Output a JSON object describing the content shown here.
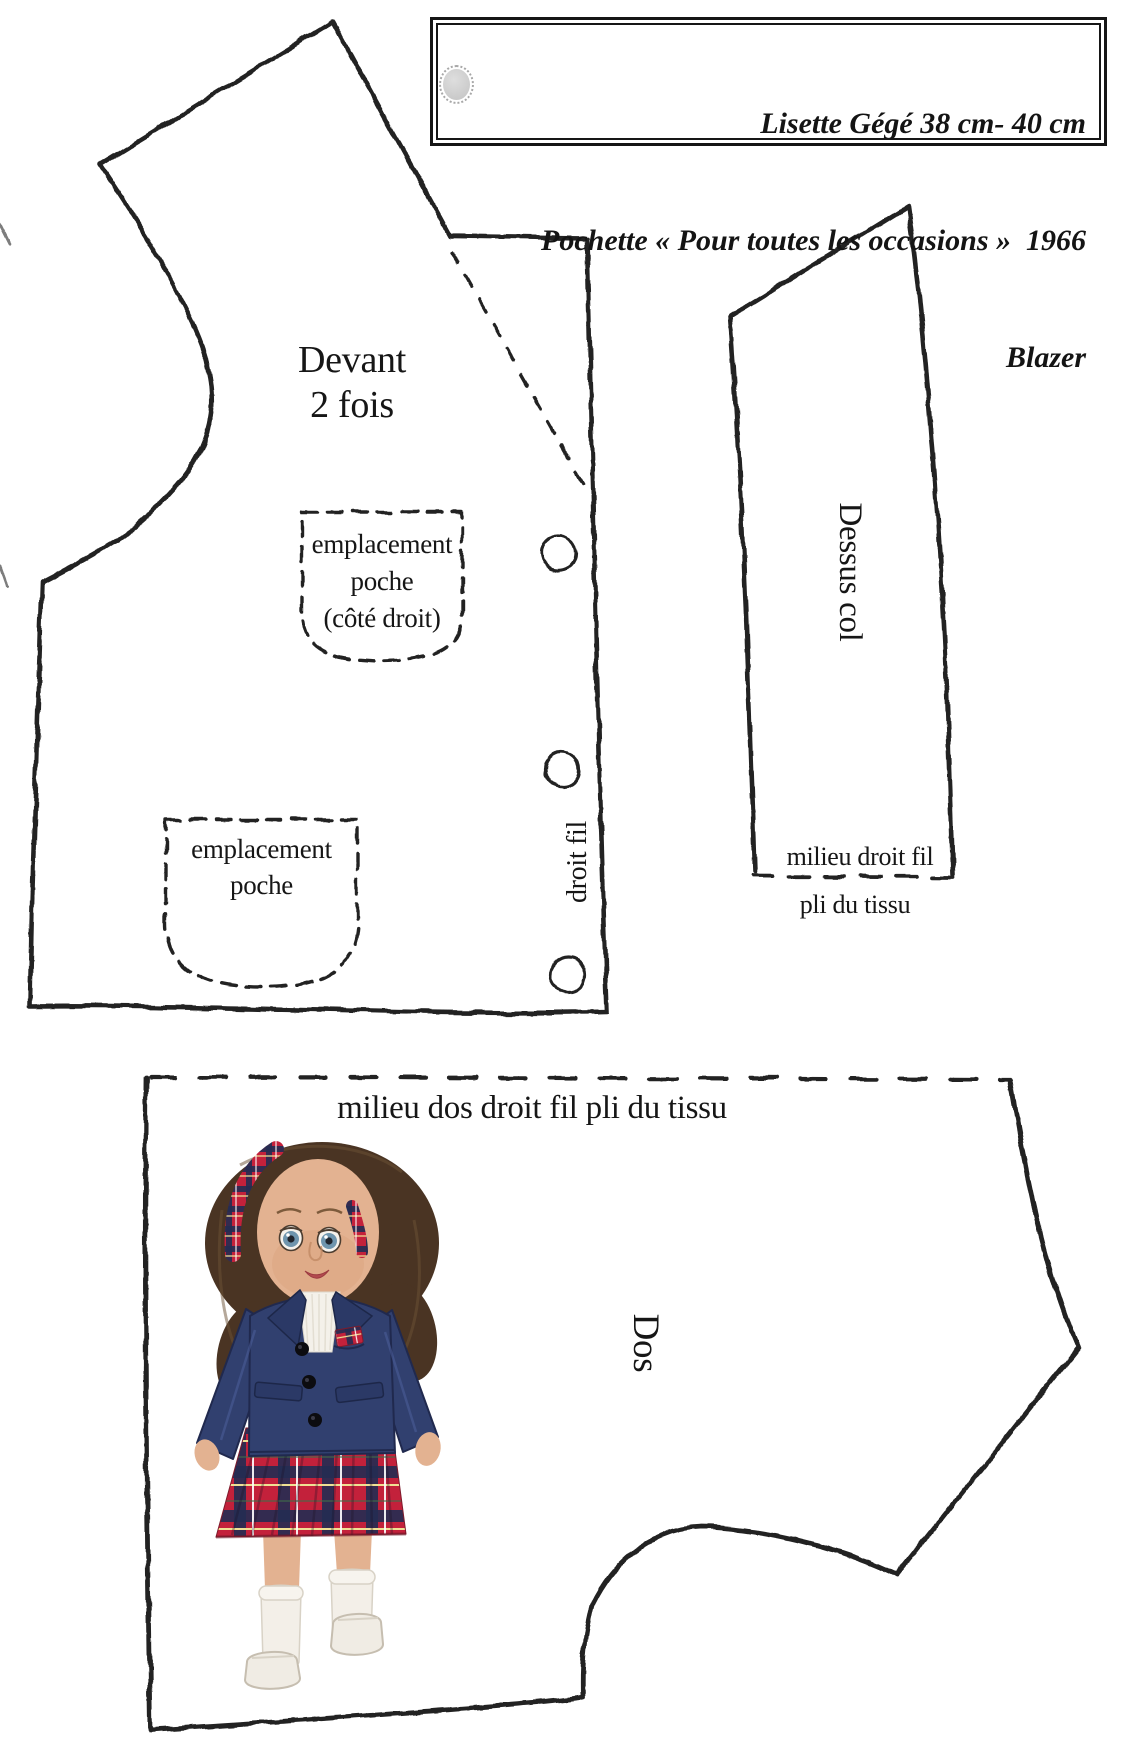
{
  "header": {
    "line1": "Lisette Gégé 38 cm- 40 cm",
    "line2": "Pochette « Pour toutes les occasions »  1966",
    "line3": "Blazer"
  },
  "pieces": {
    "front": {
      "title_line1": "Devant",
      "title_line2": "2 fois",
      "grainline_label": "droit fil",
      "buttonholes": 3,
      "pocket_right": {
        "line1": "emplacement",
        "line2": "poche",
        "line3": "(côté droit)"
      },
      "pocket_left": {
        "line1": "emplacement",
        "line2": "poche"
      }
    },
    "collar": {
      "title": "Dessus col",
      "grainline_label": "milieu droit fil",
      "fold_label": "pli du tissu"
    },
    "back": {
      "title": "Dos",
      "fold_label": "milieu dos droit fil pli du tissu"
    }
  },
  "colors": {
    "ink": "#232323",
    "paper": "#ffffff",
    "blazer_navy": "#31406f",
    "blazer_dark": "#20294e",
    "tartan_red": "#c3213b",
    "tartan_navy": "#232c52",
    "tartan_yellow": "#f0e094",
    "skin": "#e3b291",
    "hair_brown": "#4a3423",
    "headband_red": "#a52537"
  }
}
